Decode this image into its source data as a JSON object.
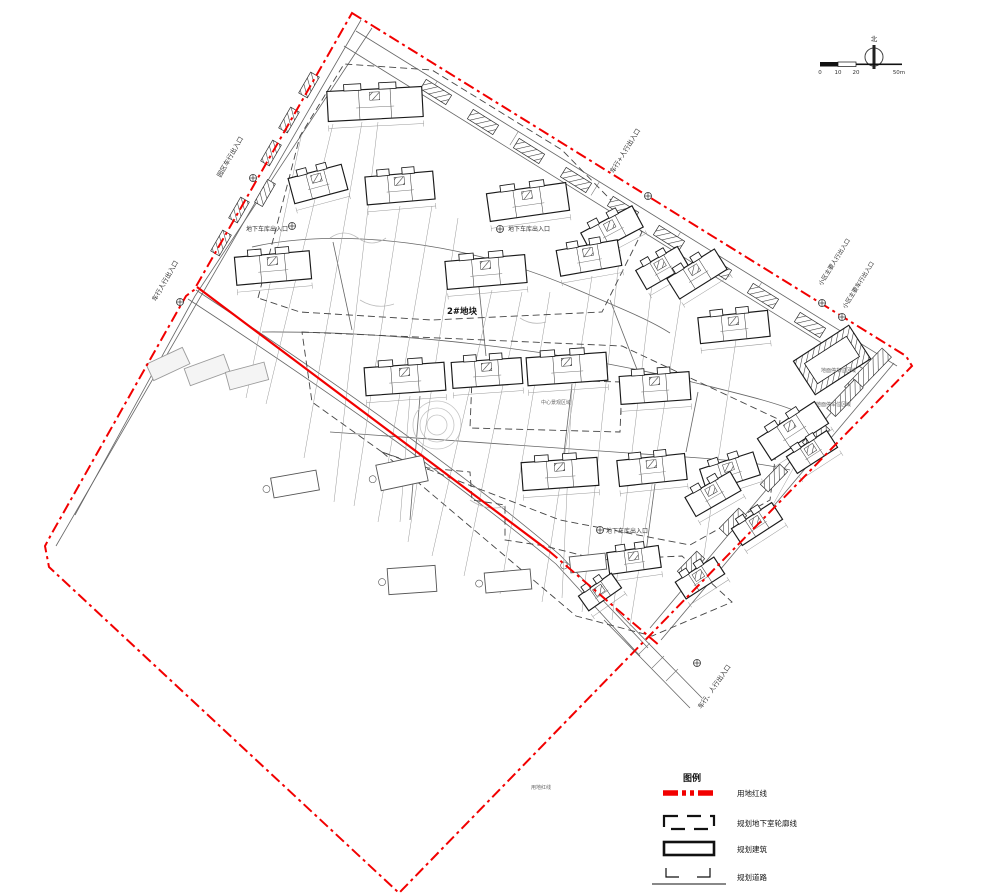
{
  "compass": {
    "north_label": "北"
  },
  "scale_bar": {
    "tick0": "0",
    "tick1": "10",
    "tick2": "20",
    "tick_end": "50m"
  },
  "plot_label": "2#地块",
  "legend": {
    "title": "图例",
    "items": [
      {
        "key": "land-redline",
        "label": "用地红线"
      },
      {
        "key": "basement-outline",
        "label": "规划地下室轮廓线"
      },
      {
        "key": "planned-building",
        "label": "规划建筑"
      },
      {
        "key": "planned-road",
        "label": "规划道路"
      }
    ]
  },
  "labels": {
    "entrance_left_top": "园区车行出入口",
    "entrance_left_garage": "地下车库出入口",
    "entrance_left_bottom": "车行人行出入口",
    "entrance_top_right": "车行+人行出入口",
    "entrance_right_ped": "小区主要人行出入口",
    "entrance_right_veh": "小区主要车行出入口",
    "entrance_bottom_right": "车行、人行出入口",
    "garage_center": "地下车库出入口",
    "garage_lower": "地下车库出入口",
    "redline_note": "用地红线",
    "parking_note_a": "地面停车位区域",
    "parking_note_b": "地面停车位区域",
    "center_green_note": "中心景观区域"
  },
  "colors": {
    "red_line": "#f20000",
    "line_dark": "#1a1a1a",
    "line_gray": "#888888",
    "existing_stroke": "#9b9b9b",
    "existing_fill": "#f4f4f4"
  }
}
